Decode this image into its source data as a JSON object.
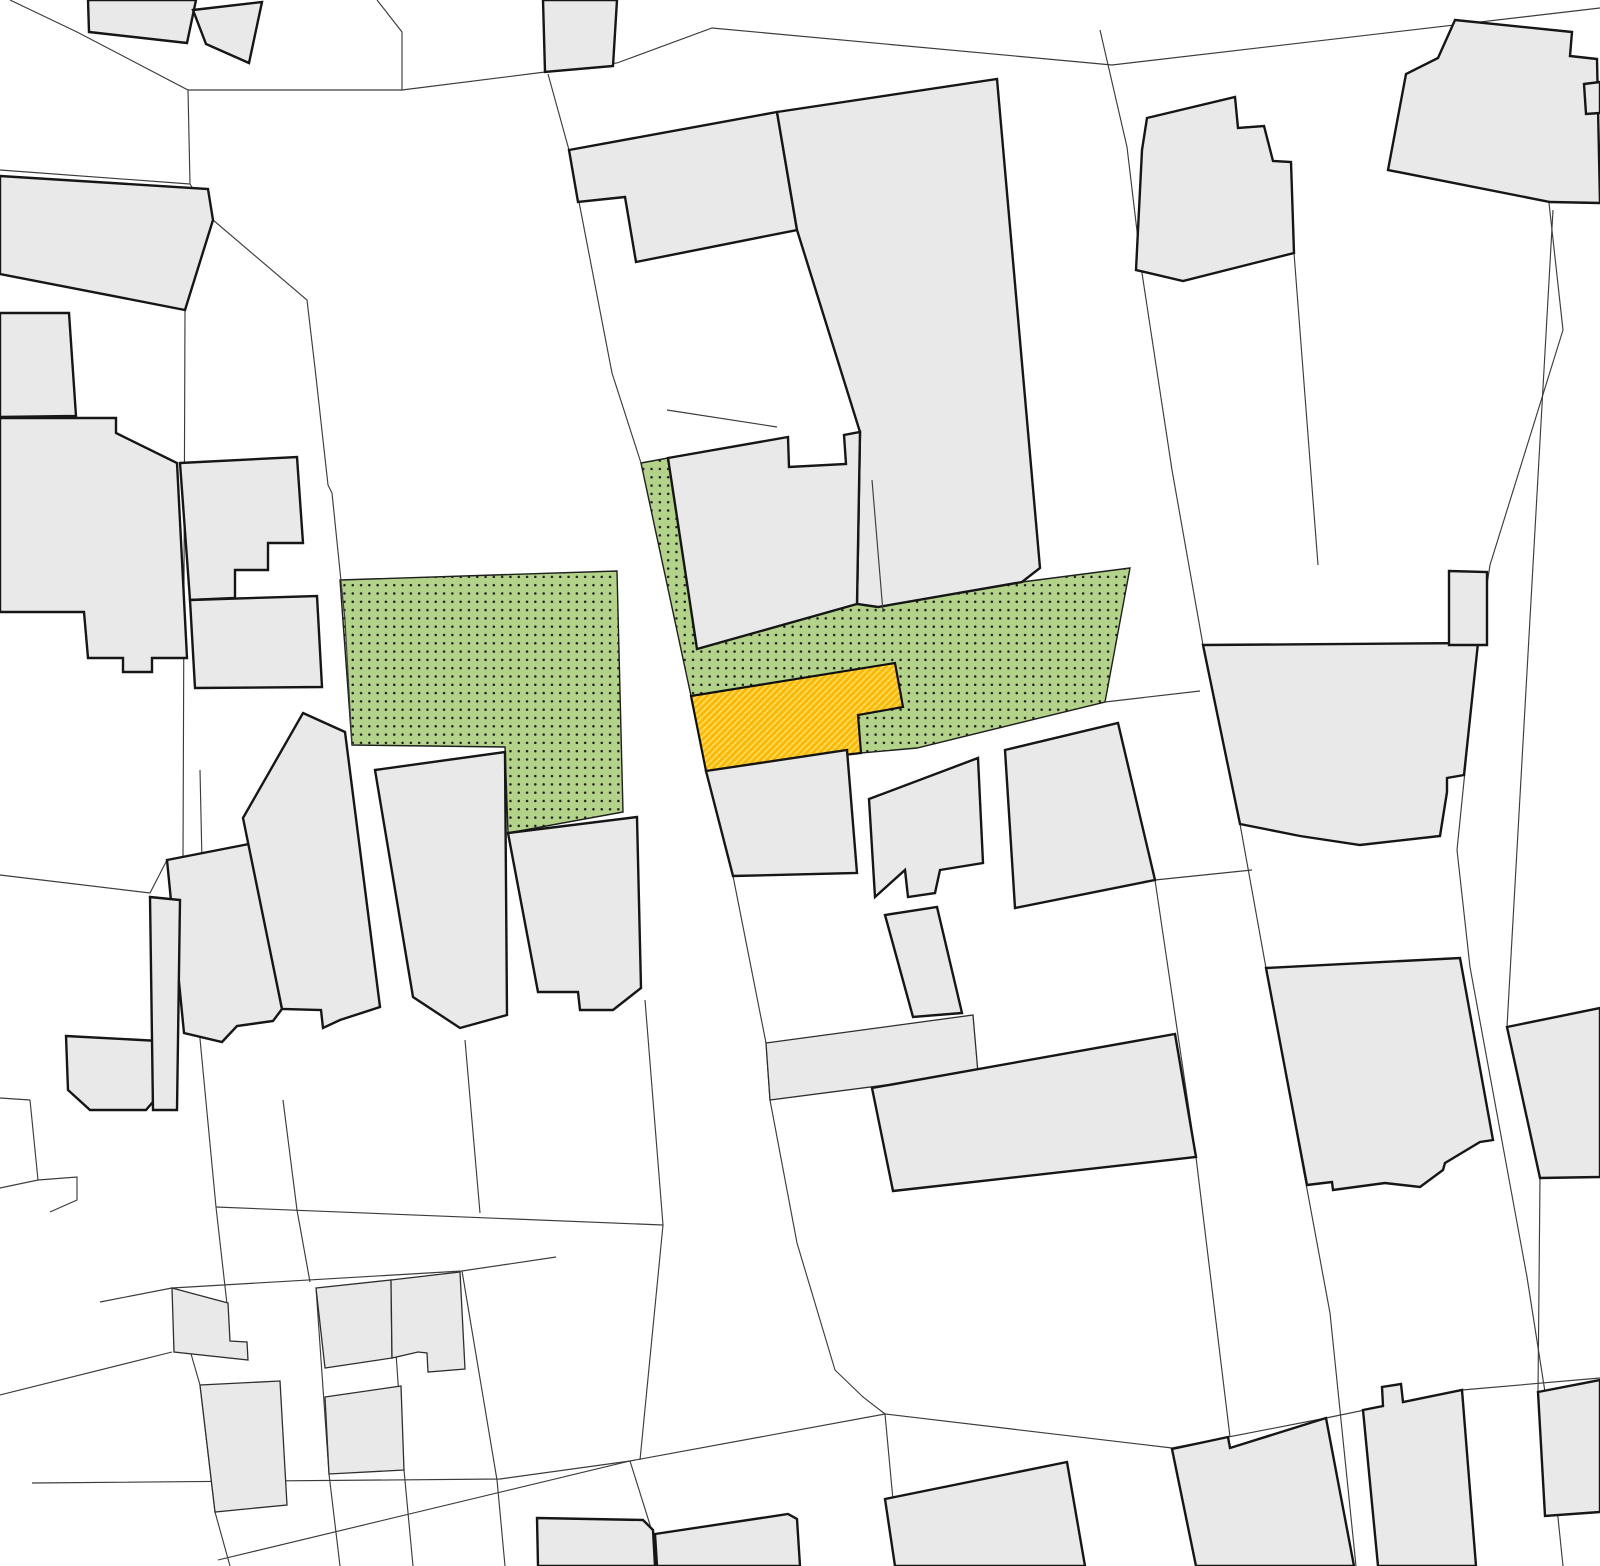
{
  "map": {
    "kind": "cadastral-site-plan",
    "canvas": {
      "width": 1600,
      "height": 1566,
      "background": "#ffffff"
    },
    "style": {
      "building_fill": "#e9e9e9",
      "building_stroke": "#161616",
      "building_stroke_width": 2.4,
      "building_thin_stroke": "#2e2e2e",
      "building_thin_stroke_width": 1.3,
      "parcel_stroke": "#3c3c3c",
      "parcel_stroke_width": 1.15,
      "green_fill": "#b4d38a",
      "green_dot_color": "#1d1d1d",
      "green_dot_spacing": 8.3,
      "green_dot_radius": 1.25,
      "green_stroke": "#1f1f1f",
      "green_stroke_width": 1.4,
      "yellow_base": "#fbb70a",
      "yellow_stripe": "#ffdd55",
      "yellow_stripe_width": 1.7,
      "yellow_stripe_period": 4.6,
      "yellow_stroke": "#101010",
      "yellow_stroke_width": 2.2
    },
    "zones": {
      "green": [
        {
          "name": "green-zone-left",
          "points": "340,580 617,571 623,812 508,833 505,747 352,745"
        },
        {
          "name": "green-zone-center-right",
          "points": "641,463 668,458 697,649 857,604 878,607 1022,582 1130,568 1105,702 917,748 861,753 858,715 903,707 895,663 691,696"
        }
      ],
      "yellow": {
        "name": "highlight-parcel-yellow",
        "points": "691,696 895,663 903,707 858,715 861,753 706,771"
      }
    },
    "buildings_thick": [
      {
        "name": "building-top-left-a",
        "points": "88,0 196,0 187,43 89,32"
      },
      {
        "name": "building-top-left-b",
        "points": "193,10 262,2 249,63 206,44"
      },
      {
        "name": "building-top-c",
        "points": "543,0 617,0 613,66 545,72"
      },
      {
        "name": "building-slanted-left",
        "points": "0,176 208,189 213,220 185,310 0,274"
      },
      {
        "name": "building-left-1",
        "points": "0,313 69,313 76,416 0,417"
      },
      {
        "name": "building-left-2",
        "points": "0,418 116,418 116,433 177,463 187,658 152,658 152,672 123,672 123,658 88,658 84,612 0,612"
      },
      {
        "name": "building-left-3",
        "points": "180,463 297,457 303,543 268,543 268,570 235,570 235,598 190,600"
      },
      {
        "name": "building-left-4",
        "points": "190,600 317,596 322,687 195,688"
      },
      {
        "name": "building-top-center-west",
        "points": "569,150 777,112 797,230 636,262 625,197 578,202"
      },
      {
        "name": "building-top-center-east",
        "points": "777,112 997,79 1040,568 1022,582 878,607 857,604 860,432 797,230"
      },
      {
        "name": "building-center-over-strip",
        "points": "668,458 788,437 789,467 846,464 844,435 860,432 857,604 697,649"
      },
      {
        "name": "building-right-col-top",
        "points": "1147,118 1235,97 1238,128 1264,126 1273,161 1291,162 1294,253 1183,281 1136,270 1142,150"
      },
      {
        "name": "building-top-right",
        "points": "1455,20 1572,32 1570,56 1597,59 1600,203 1550,202 1388,170 1406,74 1438,58"
      },
      {
        "name": "building-top-right-sliver",
        "points": "1584,84 1600,82 1600,113 1586,114"
      },
      {
        "name": "building-right-mid",
        "points": "1203,645 1478,643 1464,775 1447,778 1447,792 1440,836 1360,845 1300,836 1240,824"
      },
      {
        "name": "building-right-mid-tab",
        "points": "1449,571 1487,572 1487,645 1449,645"
      },
      {
        "name": "building-right-edge-lower",
        "points": "1507,1027 1600,1008 1600,1177 1540,1178"
      },
      {
        "name": "building-right-jagged",
        "points": "1266,968 1460,958 1493,1140 1480,1142 1445,1163 1443,1170 1420,1187 1385,1183 1333,1190 1332,1182 1307,1185"
      },
      {
        "name": "building-midrow-1",
        "points": "167,860 249,844 282,1009 273,1021 237,1026 222,1042 184,1033"
      },
      {
        "name": "building-midrow-pointed",
        "points": "303,713 345,732 380,1007 340,1020 323,1028 321,1010 282,1009 243,818"
      },
      {
        "name": "building-midrow-3",
        "points": "375,770 505,752 507,1015 460,1028 413,997"
      },
      {
        "name": "building-midrow-4",
        "points": "508,833 637,817 641,988 613,1010 580,1010 578,992 538,992"
      },
      {
        "name": "building-below-yellow",
        "points": "706,771 847,750 857,873 733,876"
      },
      {
        "name": "building-center-notched",
        "points": "869,799 978,758 983,863 940,870 935,893 908,897 905,870 875,897"
      },
      {
        "name": "building-center-small",
        "points": "885,915 937,907 962,1013 913,1017"
      },
      {
        "name": "building-center-bottom-large",
        "points": "872,1088 1175,1034 1196,1157 893,1191"
      },
      {
        "name": "building-center-east",
        "points": "1005,750 1118,723 1155,880 1015,908"
      },
      {
        "name": "building-left-edge-low-a",
        "points": "66,1036 160,1041 158,1096 146,1110 90,1110 68,1090"
      },
      {
        "name": "building-left-edge-low-b",
        "points": "150,897 180,900 177,1110 153,1110"
      },
      {
        "name": "building-bottom-k0",
        "points": "1172,1449 1228,1437 1230,1448 1326,1418 1354,1566 1196,1566"
      },
      {
        "name": "building-bottom-k1",
        "points": "1363,1410 1383,1406 1382,1387 1401,1384 1403,1402 1462,1390 1476,1566 1378,1566"
      },
      {
        "name": "building-bottom-k2",
        "points": "1538,1392 1600,1380 1600,1512 1545,1516"
      },
      {
        "name": "building-bottom-c1",
        "points": "537,1518 643,1520 653,1530 655,1566 538,1566"
      },
      {
        "name": "building-bottom-c2",
        "points": "655,1534 788,1514 797,1519 800,1566 657,1566"
      },
      {
        "name": "building-bottom-c3",
        "points": "885,1499 1067,1462 1085,1566 895,1566"
      }
    ],
    "buildings_thin": [
      {
        "name": "building-bl-1",
        "points": "172,1288 228,1303 230,1341 247,1342 248,1360 174,1352"
      },
      {
        "name": "building-bl-2",
        "points": "316,1288 391,1280 392,1358 325,1368"
      },
      {
        "name": "building-bl-3",
        "points": "391,1280 460,1272 465,1369 428,1372 427,1353 418,1352 392,1358"
      },
      {
        "name": "building-bl-4",
        "points": "200,1385 280,1381 287,1505 215,1512"
      },
      {
        "name": "building-bl-5",
        "points": "325,1397 401,1386 404,1470 329,1474"
      },
      {
        "name": "building-band-center",
        "points": "766,1043 973,1015 978,1073 770,1100"
      }
    ],
    "parcel_lines": [
      {
        "name": "parcel-top-left",
        "points": "10,0 77,32 188,90 402,90 402,32 377,0"
      },
      {
        "name": "street-north-edge",
        "points": "402,90 545,72 617,63 712,28 1112,65 1600,8"
      },
      {
        "name": "parcel-tb3-west",
        "points": "548,74 569,150"
      },
      {
        "name": "parcel-left-upper",
        "points": "0,170 190,184"
      },
      {
        "name": "street-nw-east-edge",
        "points": "188,90 190,184 213,220 307,300 315,368 328,485 332,493 345,620 352,745"
      },
      {
        "name": "street-left-west-edge",
        "points": "185,310 183,860 216,1207 228,1313"
      },
      {
        "name": "parcel-left-edge-mid",
        "points": "0,875 150,893 167,860"
      },
      {
        "name": "parcel-midrow-1",
        "points": "200,770 202,862"
      },
      {
        "name": "parcel-midrow-2",
        "points": "283,1100 297,1210 310,1282"
      },
      {
        "name": "parcel-midrow-3",
        "points": "465,1040 480,1213"
      },
      {
        "name": "parcel-midrow-4",
        "points": "645,1000 663,1225"
      },
      {
        "name": "parcel-midrow-south",
        "points": "216,1207 663,1225"
      },
      {
        "name": "parcel-midrow-connector",
        "points": "663,1225 640,1460"
      },
      {
        "name": "street-center-east-upper",
        "points": "569,150 612,373 641,463"
      },
      {
        "name": "street-center-east-lower",
        "points": "733,876 766,1043 770,1100 797,1243 835,1370 863,1397 885,1414"
      },
      {
        "name": "parcel-under-tc1",
        "points": "667,410 777,427"
      },
      {
        "name": "street-tc-east-lower",
        "points": "1155,880 1196,1157 1230,1437"
      },
      {
        "name": "parcel-right-col-west",
        "points": "1100,30 1127,147 1142,273 1172,470 1203,645"
      },
      {
        "name": "parcel-right-col-west-lower",
        "points": "1203,645 1240,824 1266,968 1330,1313 1356,1566"
      },
      {
        "name": "parcel-right-col-east",
        "points": "1549,203 1563,330 1490,565 1478,643 1457,850 1470,967 1527,1277 1545,1392 1563,1566"
      },
      {
        "name": "parcel-right-inner",
        "points": "1294,253 1318,565"
      },
      {
        "name": "street-right-east-edge",
        "points": "1553,210 1507,1027"
      },
      {
        "name": "parcel-right-lower",
        "points": "1540,1178 1538,1392"
      },
      {
        "name": "parcel-green-east",
        "points": "1105,702 1200,691"
      },
      {
        "name": "parcel-m11-east",
        "points": "1155,880 1252,870"
      },
      {
        "name": "street-bottom-north-a",
        "points": "32,1483 500,1479 630,1461"
      },
      {
        "name": "street-bottom-north-b",
        "points": "218,1560 630,1461 885,1414 1172,1448"
      },
      {
        "name": "parcel-bottom-k",
        "points": "1172,1448 1326,1418 1462,1390 1600,1378"
      },
      {
        "name": "parcel-bc-1",
        "points": "630,1461 651,1528"
      },
      {
        "name": "parcel-bc-2",
        "points": "885,1414 893,1500"
      },
      {
        "name": "parcel-bl-top",
        "points": "100,1302 172,1288 462,1271 556,1257"
      },
      {
        "name": "parcel-bl-v1",
        "points": "172,1288 200,1385 215,1512 230,1566"
      },
      {
        "name": "parcel-bl-v2",
        "points": "316,1288 329,1474 340,1566"
      },
      {
        "name": "parcel-bl-v3",
        "points": "391,1280 404,1470 413,1566"
      },
      {
        "name": "parcel-bl-v4",
        "points": "462,1271 497,1480 505,1566"
      },
      {
        "name": "parcel-bl-left",
        "points": "0,1395 172,1352"
      },
      {
        "name": "parcel-bl-corner",
        "points": "30,1100 38,1180 0,1188"
      },
      {
        "name": "parcel-bl-pentagon",
        "points": "38,1180 77,1177 77,1200 50,1212"
      },
      {
        "name": "parcel-left-edge-top",
        "points": "0,1098 30,1100"
      }
    ],
    "overlay_lines": [
      {
        "name": "parcel-cross-gray",
        "points": "872,480 883,612"
      }
    ]
  }
}
